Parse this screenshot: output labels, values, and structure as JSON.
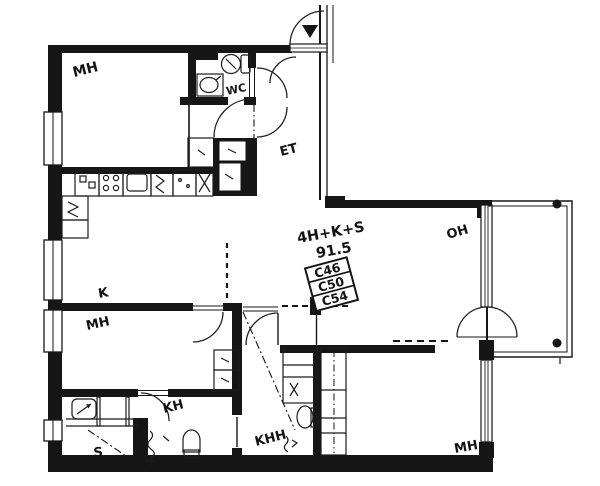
{
  "plan": {
    "title_type": "4H+K+S",
    "title_area": "91.5",
    "unit_numbers": [
      "C46",
      "C50",
      "C54"
    ],
    "labels": {
      "bedroom_top": "MH",
      "toilet": "WC",
      "entry": "ET",
      "kitchen": "K",
      "bedroom_mid": "MH",
      "bathroom": "KH",
      "utility": "KHH",
      "sauna": "S",
      "living": "OH",
      "bedroom_bottom": "MH"
    }
  }
}
